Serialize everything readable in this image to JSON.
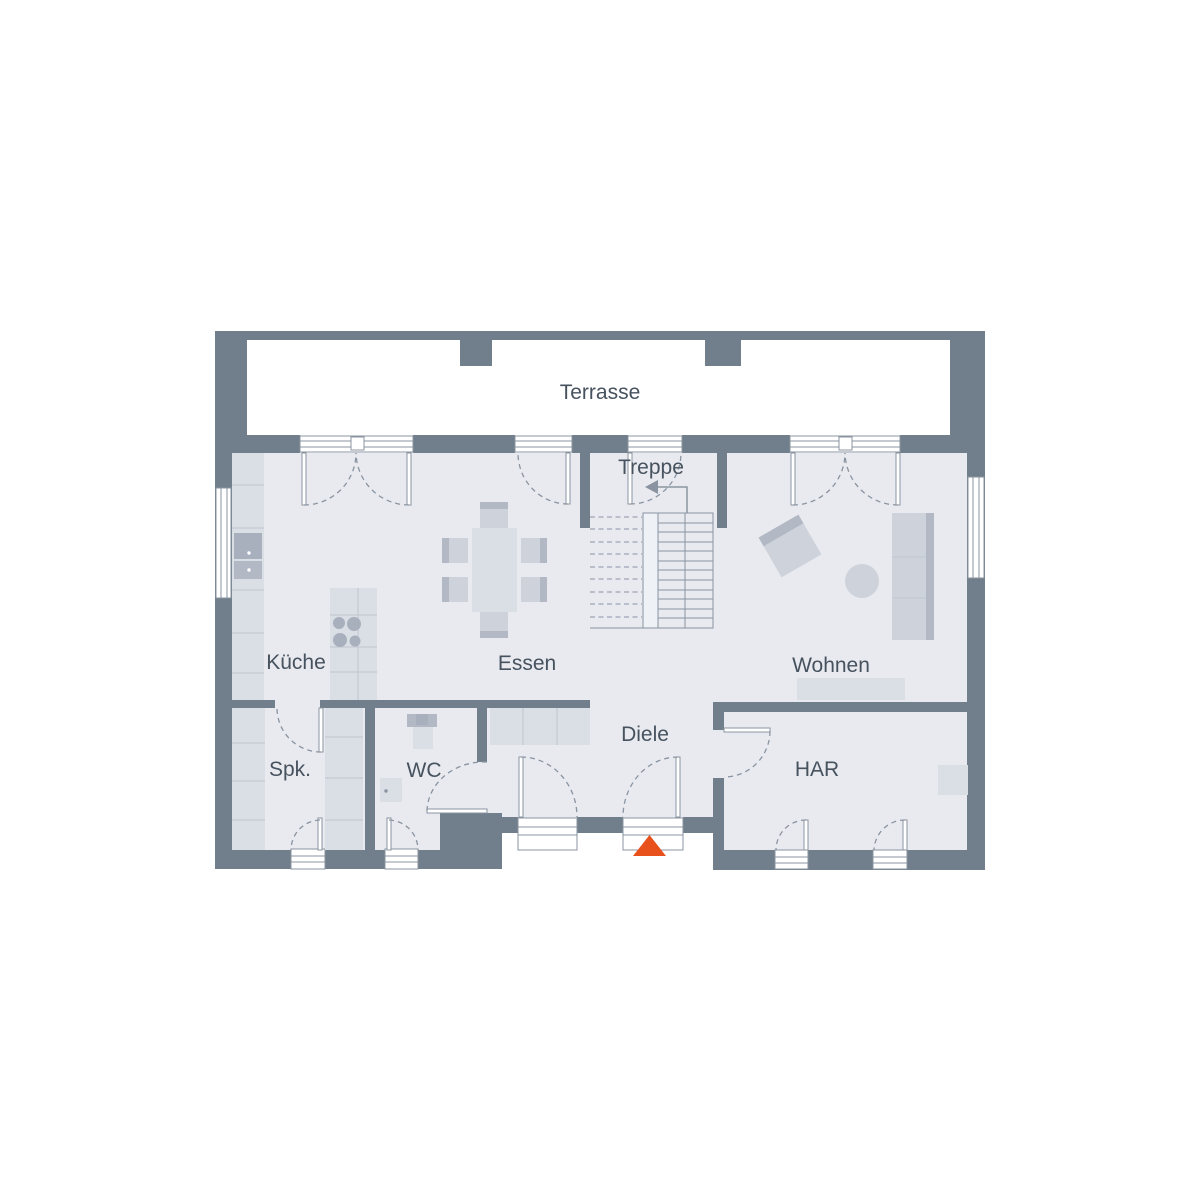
{
  "rooms": {
    "terrasse": "Terrasse",
    "treppe": "Treppe",
    "kueche": "Küche",
    "essen": "Essen",
    "wohnen": "Wohnen",
    "spk": "Spk.",
    "wc": "WC",
    "diele": "Diele",
    "har": "HAR"
  },
  "colors": {
    "background": "#ffffff",
    "wall": "#717E8C",
    "floor": "#E8EAEF",
    "floor_light": "#EEF1F5",
    "furniture_light": "#DADEE5",
    "furniture_mid": "#CED3DB",
    "furniture_dark": "#B2B9C4",
    "appliance": "#A8B0BD",
    "line": "#8A94A1",
    "text": "#47525F",
    "entrance_marker": "#E8501C"
  }
}
